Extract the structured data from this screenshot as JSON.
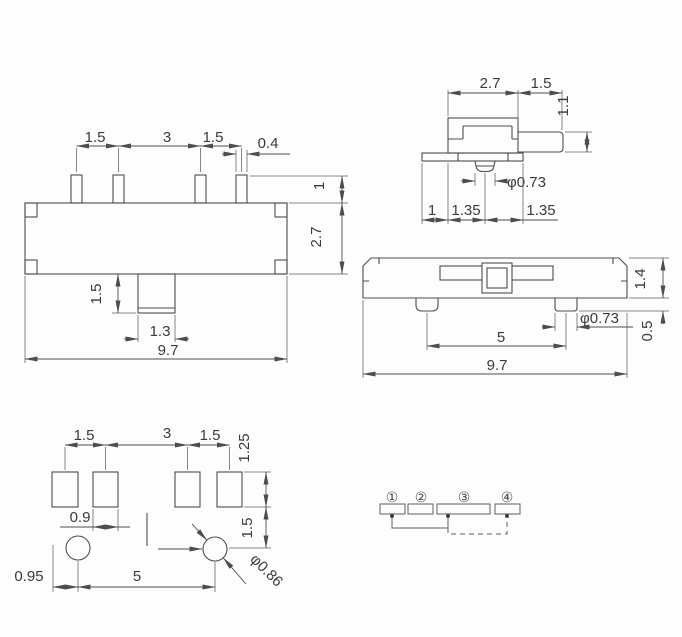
{
  "front_view": {
    "pin_pitch_1": "1.5",
    "pin_pitch_2": "3",
    "pin_pitch_3": "1.5",
    "pin_width": "0.4",
    "pin_height": "1",
    "body_height": "2.7",
    "knob_height": "1.5",
    "knob_width": "1.3",
    "body_width": "9.7"
  },
  "side_view": {
    "body_depth": "2.7",
    "actuator_length": "1.5",
    "actuator_height": "1.1",
    "post_diameter": "φ0.73",
    "flange_offset": "1",
    "post_offset_left": "1.35",
    "post_offset_right": "1.35"
  },
  "bottom_view": {
    "body_thickness": "1.4",
    "post_height": "0.5",
    "post_diameter": "φ0.73",
    "post_spacing": "5",
    "body_width": "9.7"
  },
  "pcb_layout": {
    "pad_pitch_1": "1.5",
    "pad_pitch_2": "3",
    "pad_pitch_3": "1.5",
    "pad_height": "1.25",
    "pad_width": "0.9",
    "pad_to_hole": "1.5",
    "edge_to_hole": "0.95",
    "hole_spacing": "5",
    "hole_diameter": "φ0.86"
  },
  "schematic": {
    "pins": [
      "①",
      "②",
      "③",
      "④"
    ]
  }
}
